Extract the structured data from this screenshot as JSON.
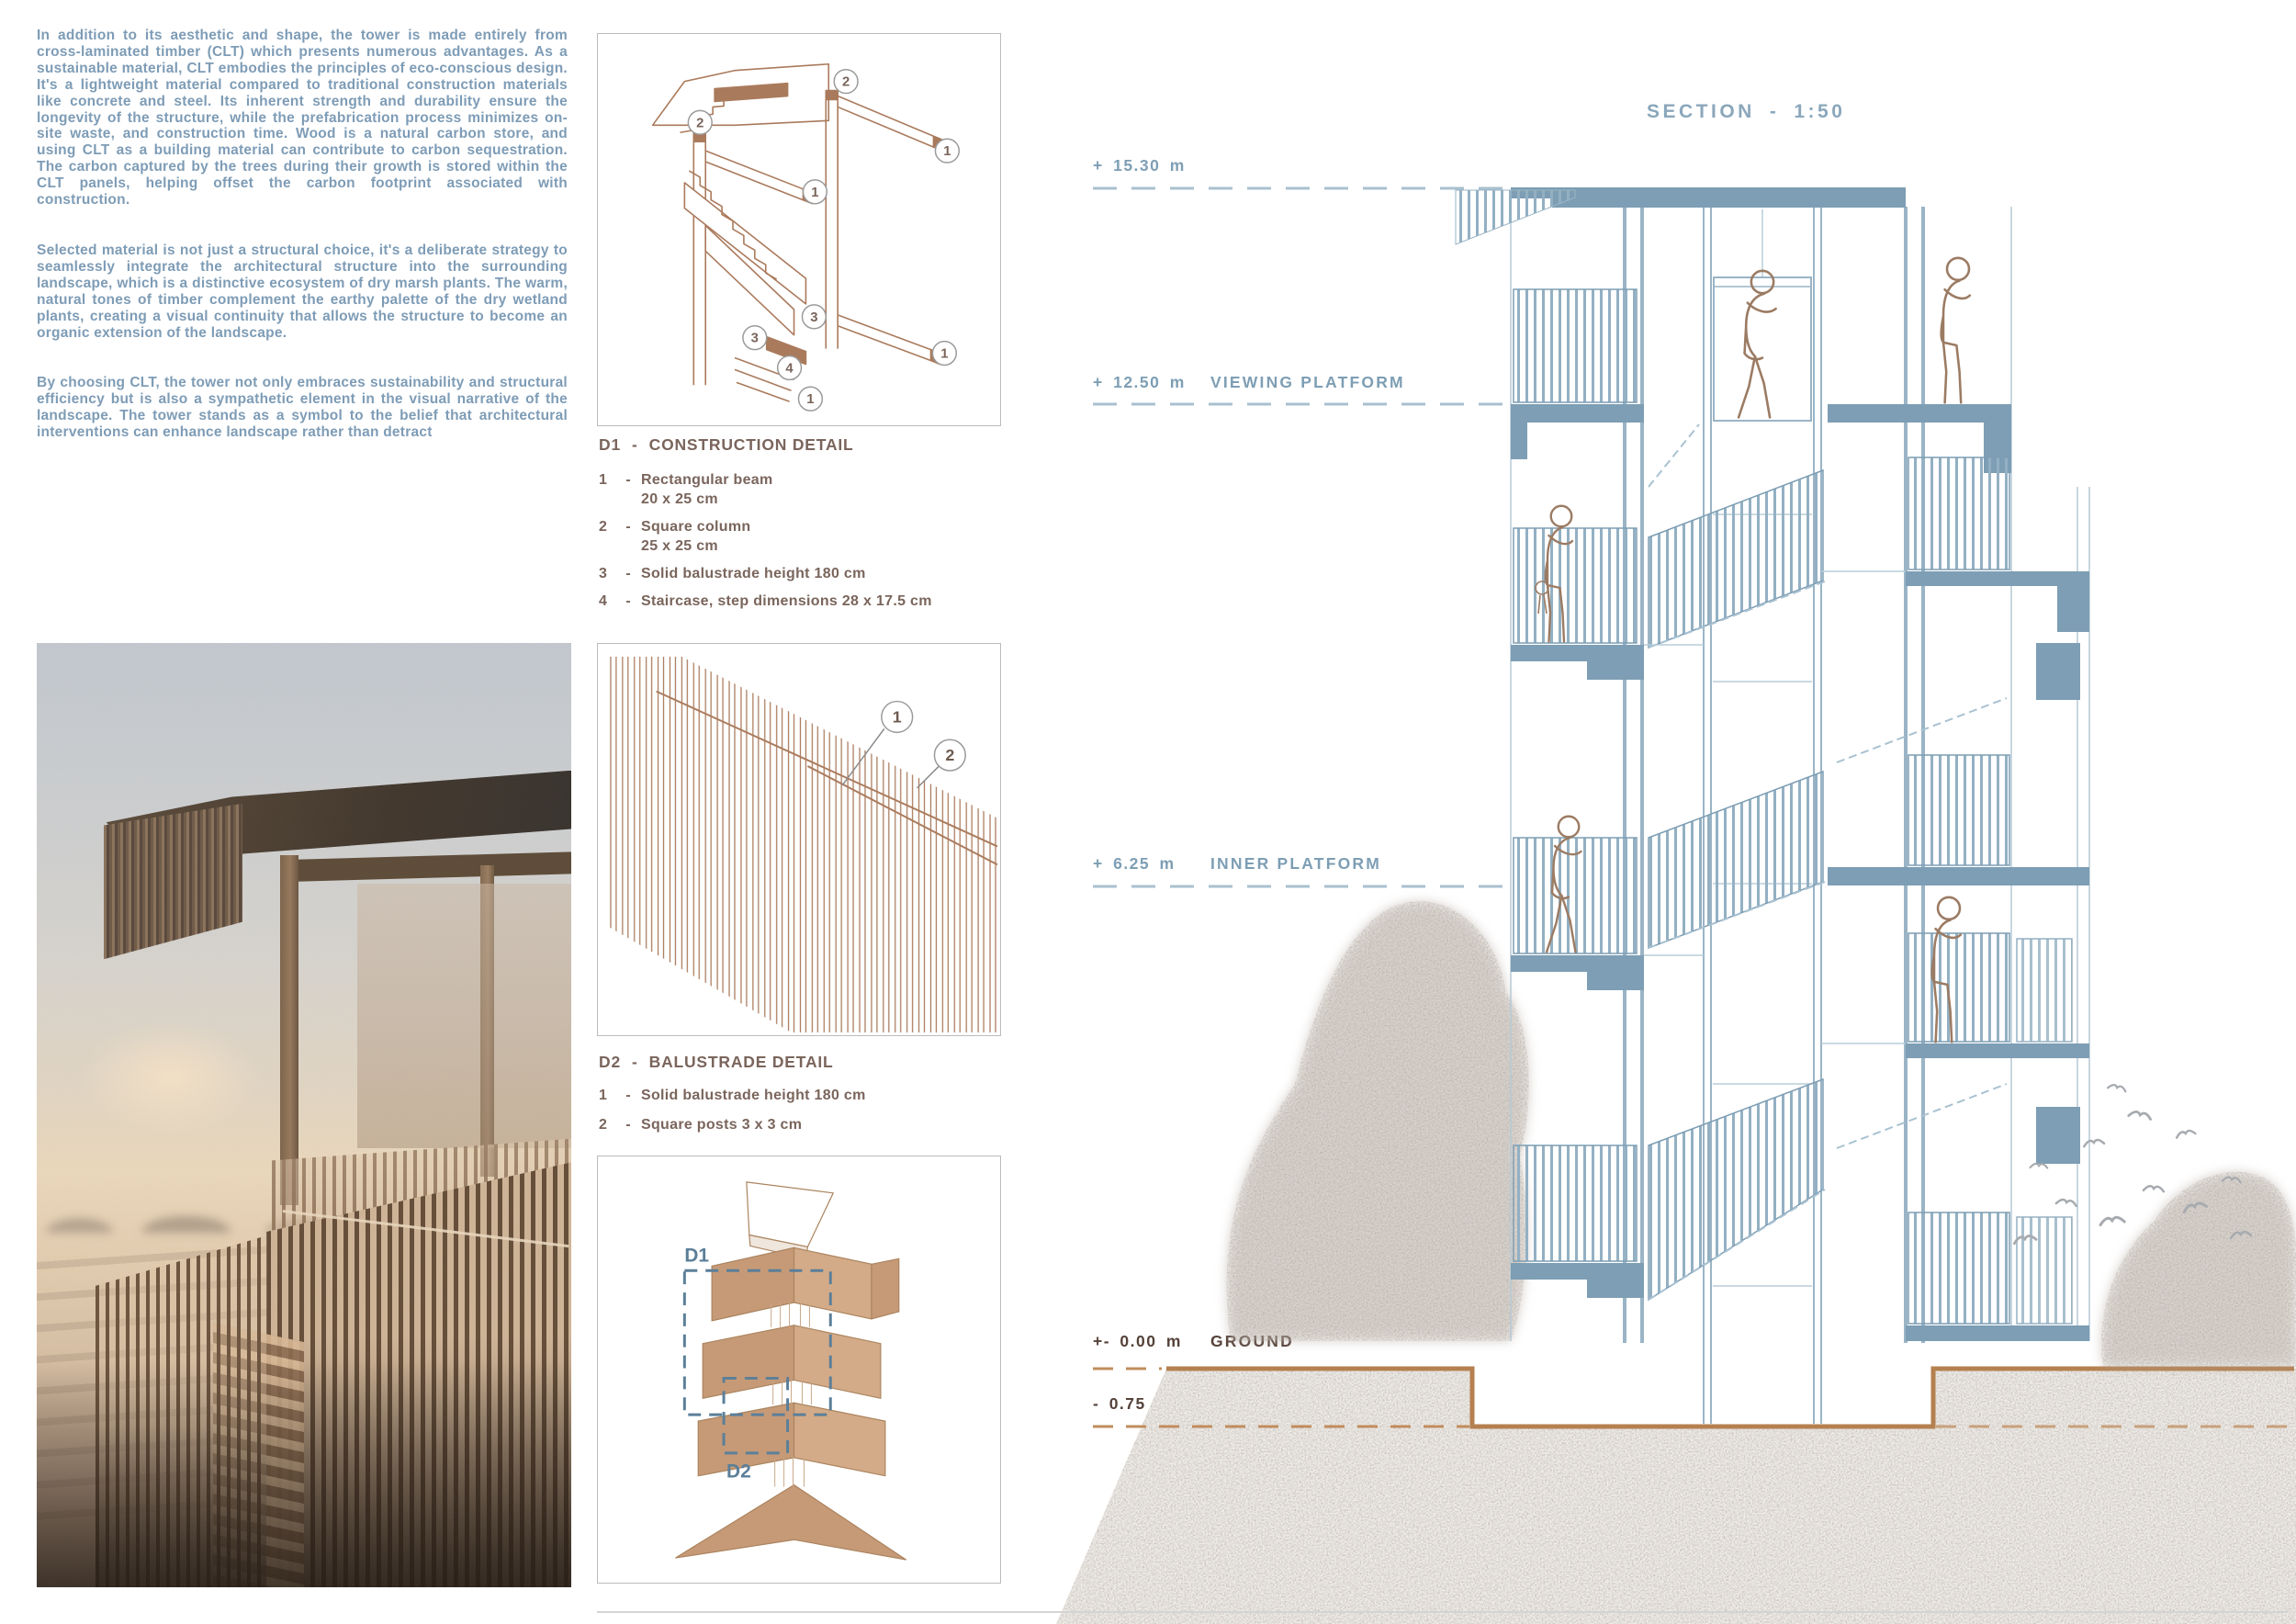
{
  "colors": {
    "text_blue": "#7e9cb6",
    "drawing_blue": "#7d9eb4",
    "detail_brown": "#aa7a5c",
    "label_taupe": "#7a655c",
    "ground_brown": "#b5804f",
    "dark_label": "#55423a",
    "axon_tan": "#c69a77"
  },
  "intro": {
    "paragraphs": [
      "In addition to its aesthetic and shape, the tower is made entirely from cross-laminated timber (CLT) which presents numerous advantages. As a sustainable material, CLT embodies the principles of eco-conscious design. It's a lightweight material compared to traditional construction materials like concrete and steel. Its inherent strength and durability ensure the longevity of the structure, while the prefabrication process minimizes on-site waste, and construction time. Wood is a natural carbon store, and using CLT as a building material can contribute to carbon sequestration. The carbon captured by the trees during their growth is stored within the CLT panels, helping offset the carbon footprint associated with construction.",
      "Selected material is not just a structural choice, it's a deliberate strategy to seamlessly integrate the architectural structure into the surrounding landscape, which is a distinctive ecosystem of dry marsh plants. The warm, natural tones of timber complement the earthy palette of the dry wetland plants, creating a visual continuity that allows the structure to become an organic extension of the landscape.",
      "By choosing CLT, the tower not only embraces sustainability and structural efficiency but is also a sympathetic element in the visual narrative of the landscape. The tower stands as a symbol to the belief that architectural interventions can enhance landscape rather than detract"
    ]
  },
  "details": {
    "dash": "-",
    "d1": {
      "code": "D1",
      "title": "CONSTRUCTION DETAIL",
      "items": [
        {
          "num": "1",
          "text": "Rectangular beam\n20 x 25 cm"
        },
        {
          "num": "2",
          "text": "Square column\n25 x 25 cm"
        },
        {
          "num": "3",
          "text": "Solid balustrade height 180 cm"
        },
        {
          "num": "4",
          "text": "Staircase, step dimensions 28 x 17.5 cm"
        }
      ]
    },
    "d2": {
      "code": "D2",
      "title": "BALUSTRADE DETAIL",
      "items": [
        {
          "num": "1",
          "text": "Solid balustrade height 180 cm"
        },
        {
          "num": "2",
          "text": "Square posts 3 x 3 cm"
        }
      ]
    }
  },
  "axon": {
    "d1_label": "D1",
    "d2_label": "D2"
  },
  "section": {
    "title": "SECTION",
    "title_dash": "-",
    "title_scale": "1:50",
    "levels": [
      {
        "value": "+ 15.30 m",
        "label": ""
      },
      {
        "value": "+ 12.50 m",
        "label": "VIEWING PLATFORM"
      },
      {
        "value": "+ 6.25 m",
        "label": "INNER PLATFORM"
      },
      {
        "value": "+- 0.00 m",
        "label": "GROUND"
      },
      {
        "value": "- 0.75 m",
        "label": "ELEVATOR ENTRANCE"
      }
    ]
  }
}
